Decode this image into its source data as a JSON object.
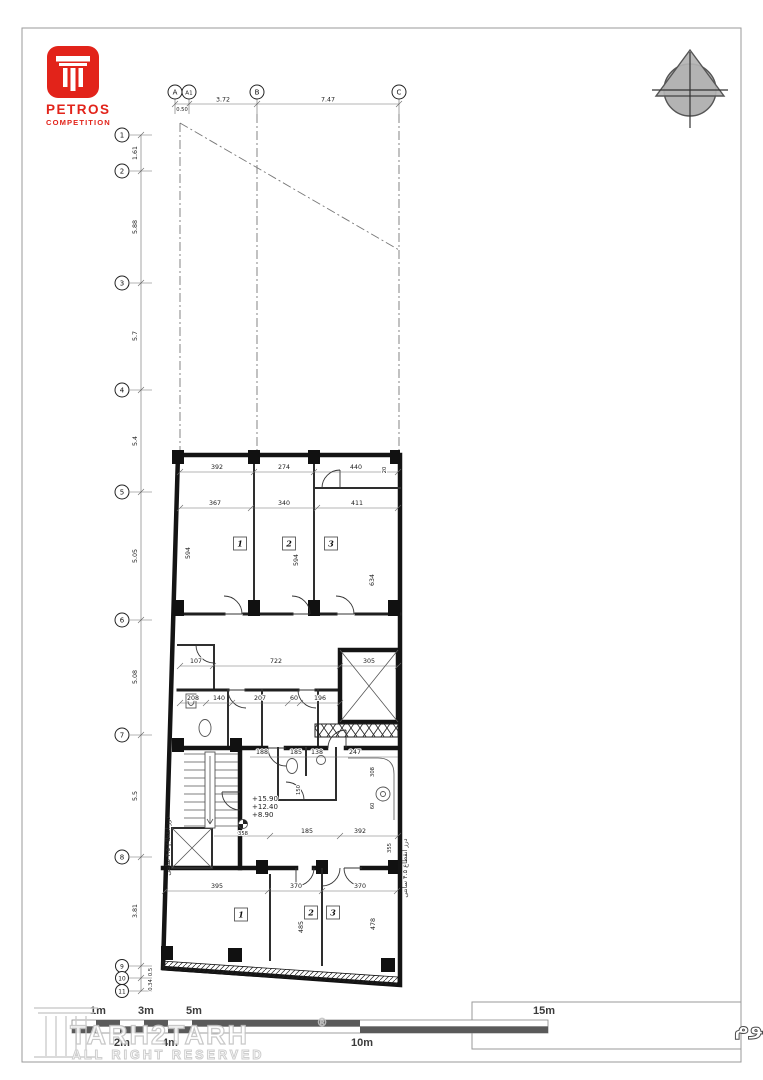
{
  "logo": {
    "brand": "PETROS",
    "sub": "COMPETITION",
    "color": "#e2231a"
  },
  "grid": {
    "top_labels": [
      "A",
      "A1",
      "B",
      "C"
    ],
    "top_dims": {
      "aa1": "0.50",
      "a1b": "3.72",
      "bc": "7.47"
    },
    "left_labels": [
      "1",
      "2",
      "3",
      "4",
      "5",
      "6",
      "7",
      "8",
      "9",
      "10",
      "11"
    ],
    "left_dims": [
      "1.61",
      "5.88",
      "5.7",
      "5.4",
      "5.05",
      "5.08",
      "5.5",
      "3.81",
      "0.5",
      "0.34"
    ]
  },
  "plan": {
    "upper_rooms": [
      "1",
      "2",
      "3"
    ],
    "lower_rooms": [
      "1",
      "2",
      "3"
    ],
    "levels": [
      "+15.90",
      "+12.40",
      "+8.90"
    ],
    "level_point": "358",
    "dims": {
      "u1": "392",
      "u2": "274",
      "u3": "440",
      "u4": "367",
      "u5": "340",
      "u6": "411",
      "v1": "594",
      "v2": "594",
      "v3": "634",
      "v4": "20",
      "c1": "107",
      "c2": "722",
      "c3": "305",
      "w1": "208",
      "w2": "140",
      "w3": "207",
      "w4": "60",
      "w5": "196",
      "m1": "188",
      "m2": "185",
      "m3": "138",
      "m4": "247",
      "m5": "150",
      "m6": "308",
      "m7": "60",
      "k1": "185",
      "k2": "392",
      "k3": "355",
      "l1": "395",
      "l2": "370",
      "l3": "370",
      "lv1": "485",
      "lv2": "478"
    },
    "notes": {
      "joint_left": "درز انقطاع ۴.۵ سانتی",
      "joint_right": "درز انقطاع ۴.۵ سانتی"
    }
  },
  "scalebar": {
    "top": [
      "1m",
      "3m",
      "5m",
      "15m"
    ],
    "bottom": [
      "2m",
      "4m",
      "10m"
    ]
  },
  "title": "پلان اندازه گذاری طبقات اول تا سوم",
  "watermark": {
    "brand": "TARH2TARH",
    "reg": "®",
    "sub": "ALL RIGHT RESERVED"
  }
}
